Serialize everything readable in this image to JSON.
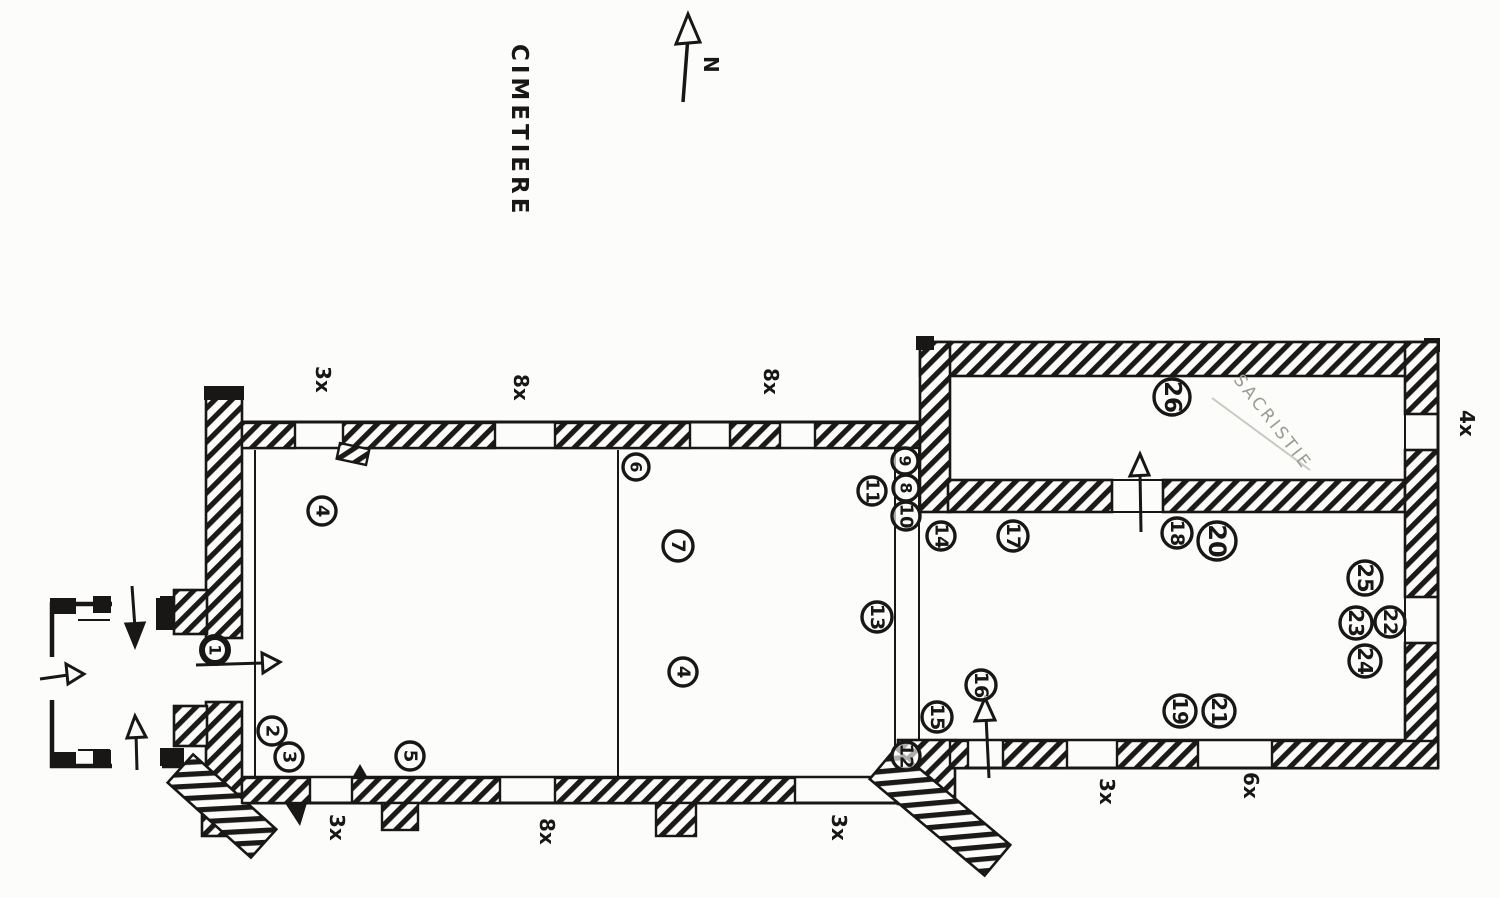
{
  "page": {
    "background": "#fcfcfa",
    "ink_color": "#181716",
    "pencil_color": "#9a9a92",
    "drawing_type": "hand-drawn church floor plan with numbered photo positions"
  },
  "annotations": {
    "cemetery": {
      "text": "CIMETIERE",
      "x": 512,
      "y": 44
    },
    "sacristy": {
      "text": "SACRISTIE",
      "x": 1233,
      "y": 380
    },
    "north": {
      "text": "N",
      "x": 704,
      "y": 56
    }
  },
  "facade_photo_labels": [
    {
      "text": "3x",
      "x": 316,
      "y": 366
    },
    {
      "text": "8x",
      "x": 514,
      "y": 374
    },
    {
      "text": "8x",
      "x": 764,
      "y": 368
    },
    {
      "text": "4x",
      "x": 1460,
      "y": 410
    },
    {
      "text": "3x",
      "x": 330,
      "y": 814
    },
    {
      "text": "8x",
      "x": 540,
      "y": 818
    },
    {
      "text": "3x",
      "x": 832,
      "y": 814
    },
    {
      "text": "3x",
      "x": 1100,
      "y": 778
    },
    {
      "text": "6x",
      "x": 1244,
      "y": 772
    }
  ],
  "photo_markers": [
    {
      "label": "1",
      "x": 215,
      "y": 650,
      "r": 13,
      "heavy": true
    },
    {
      "label": "2",
      "x": 272,
      "y": 731,
      "r": 14
    },
    {
      "label": "3",
      "x": 289,
      "y": 757,
      "r": 14
    },
    {
      "label": "4",
      "x": 322,
      "y": 511,
      "r": 14
    },
    {
      "label": "5",
      "x": 410,
      "y": 756,
      "r": 14
    },
    {
      "label": "6",
      "x": 636,
      "y": 467,
      "r": 13
    },
    {
      "label": "7",
      "x": 678,
      "y": 546,
      "r": 15
    },
    {
      "label": "4",
      "x": 683,
      "y": 672,
      "r": 14
    },
    {
      "label": "9",
      "x": 905,
      "y": 461,
      "r": 13
    },
    {
      "label": "8",
      "x": 906,
      "y": 488,
      "r": 13
    },
    {
      "label": "10",
      "x": 906,
      "y": 516,
      "r": 14
    },
    {
      "label": "11",
      "x": 872,
      "y": 491,
      "r": 14
    },
    {
      "label": "13",
      "x": 877,
      "y": 617,
      "r": 15
    },
    {
      "label": "12",
      "x": 906,
      "y": 756,
      "r": 14
    },
    {
      "label": "14",
      "x": 941,
      "y": 536,
      "r": 14
    },
    {
      "label": "15",
      "x": 937,
      "y": 717,
      "r": 15
    },
    {
      "label": "16",
      "x": 981,
      "y": 685,
      "r": 15
    },
    {
      "label": "17",
      "x": 1013,
      "y": 536,
      "r": 15
    },
    {
      "label": "18",
      "x": 1177,
      "y": 533,
      "r": 15
    },
    {
      "label": "20",
      "x": 1217,
      "y": 541,
      "r": 19
    },
    {
      "label": "19",
      "x": 1180,
      "y": 711,
      "r": 16
    },
    {
      "label": "21",
      "x": 1219,
      "y": 711,
      "r": 16
    },
    {
      "label": "25",
      "x": 1365,
      "y": 578,
      "r": 17
    },
    {
      "label": "23",
      "x": 1356,
      "y": 623,
      "r": 16
    },
    {
      "label": "22",
      "x": 1390,
      "y": 622,
      "r": 15
    },
    {
      "label": "24",
      "x": 1365,
      "y": 661,
      "r": 16
    },
    {
      "label": "26",
      "x": 1172,
      "y": 397,
      "r": 18
    }
  ]
}
